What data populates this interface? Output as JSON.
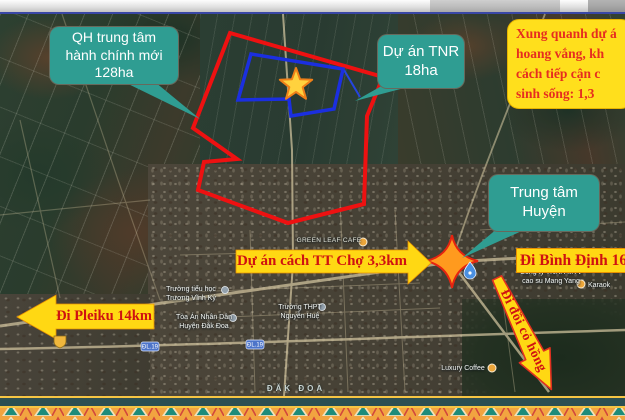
{
  "callouts": {
    "qh_center": {
      "lines": [
        "QH trung tâm",
        "hành chính mới",
        "128ha"
      ]
    },
    "tnr": {
      "lines": [
        "Dự án TNR",
        "18ha"
      ]
    },
    "district_center": {
      "lines": [
        "Trung tâm",
        "Huyện"
      ]
    }
  },
  "info_box": {
    "lines": [
      "Xung quanh dự á",
      "hoang vắng, kh",
      "cách tiếp cận c",
      "sinh sống: 1,3"
    ]
  },
  "banners": {
    "market": "Dự án cách TT Chợ 3,3km",
    "pleiku": "Đi Pleiku 14km",
    "binh_dinh": "Đi Bình Định 16",
    "pink_hill": "Đi đồi cỏ hồng"
  },
  "map_labels": {
    "area_name": "ĐĂK ĐOA",
    "school_primary": [
      "Trường tiểu học",
      "Trương Vĩnh Ký"
    ],
    "court": [
      "Tòa Án Nhân Dân",
      "Huyện Đắk Đoa"
    ],
    "school_high": [
      "Trường THPT",
      "Nguyễn Huệ"
    ],
    "cafe": "GREEN LEAF CAFE",
    "rubber_company": [
      "Công ty TNHH MTV",
      "cao su Mang Yang"
    ],
    "karaoke": "Karaok",
    "coffee": "Luxury Coffee",
    "road_shield": "ĐL.19"
  },
  "colors": {
    "teal_callout": "#2f9d92",
    "banner_yellow": "#ffd813",
    "banner_red_text": "#cf1111",
    "project_boundary_red": "#ee1111",
    "tnr_boundary_blue": "#1b2fe0",
    "info_box_yellow": "#ffdf1c",
    "border_teal": "#2c4f52",
    "border_orange": "#f2a440"
  }
}
